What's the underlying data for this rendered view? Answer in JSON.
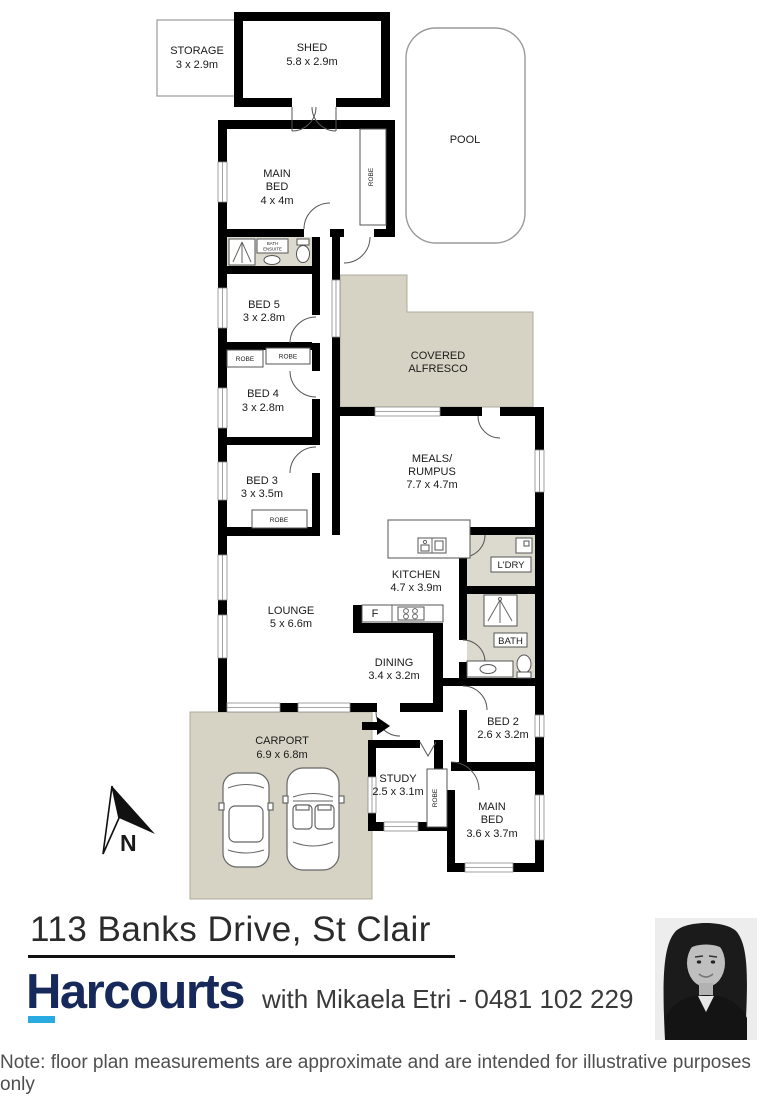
{
  "page": {
    "address": "113 Banks Drive, St Clair",
    "brand": "Harcourts",
    "agent_line": "with Mikaela Etri - 0481 102 229",
    "note": "Note: floor plan measurements are approximate and are intended for illustrative purposes only",
    "compass": "N"
  },
  "colors": {
    "wall": "#000000",
    "outdoor_fill": "#d7d3c4",
    "wet_fill": "#dcdacf",
    "brand_navy": "#16295a",
    "brand_cyan": "#29abe2"
  },
  "icons": {
    "north_arrow": "north-arrow-icon",
    "entry_arrow": "entry-direction-arrow",
    "shower": "shower-icon",
    "toilet": "toilet-icon",
    "basin": "basin-icon",
    "cars": "car-top-view-icon"
  },
  "rooms": {
    "storage": {
      "name": "STORAGE",
      "dims": "3 x 2.9m"
    },
    "shed": {
      "name": "SHED",
      "dims": "5.8 x 2.9m"
    },
    "pool": {
      "name": "POOL"
    },
    "main_bed_upper": {
      "line1": "MAIN",
      "line2": "BED",
      "dims": "4 x 4m"
    },
    "robe_main_upper": {
      "name": "ROBE"
    },
    "ensuite": {
      "line1": "BATH",
      "line2": "ENSUITE"
    },
    "bed5": {
      "name": "BED 5",
      "dims": "3 x 2.8m"
    },
    "robe_a": {
      "name": "ROBE"
    },
    "robe_b": {
      "name": "ROBE"
    },
    "bed4": {
      "name": "BED 4",
      "dims": "3 x 2.8m"
    },
    "bed3": {
      "name": "BED 3",
      "dims": "3 x 3.5m"
    },
    "robe_bed3": {
      "name": "ROBE"
    },
    "alfresco": {
      "line1": "COVERED",
      "line2": "ALFRESCO"
    },
    "meals": {
      "line1": "MEALS/",
      "line2": "RUMPUS",
      "dims": "7.7 x 4.7m"
    },
    "kitchen": {
      "name": "KITCHEN",
      "dims": "4.7 x 3.9m"
    },
    "fridge": {
      "abbr": "F"
    },
    "laundry": {
      "name": "L'DRY"
    },
    "bath": {
      "name": "BATH"
    },
    "lounge": {
      "name": "LOUNGE",
      "dims": "5 x 6.6m"
    },
    "dining": {
      "name": "DINING",
      "dims": "3.4 x 3.2m"
    },
    "bed2": {
      "name": "BED 2",
      "dims": "2.6 x 3.2m"
    },
    "carport": {
      "name": "CARPORT",
      "dims": "6.9 x 6.8m"
    },
    "study": {
      "name": "STUDY",
      "dims": "2.5 x 3.1m"
    },
    "robe_study": {
      "name": "ROBE"
    },
    "main_bed_lower": {
      "line1": "MAIN",
      "line2": "BED",
      "dims": "3.6 x 3.7m"
    }
  }
}
